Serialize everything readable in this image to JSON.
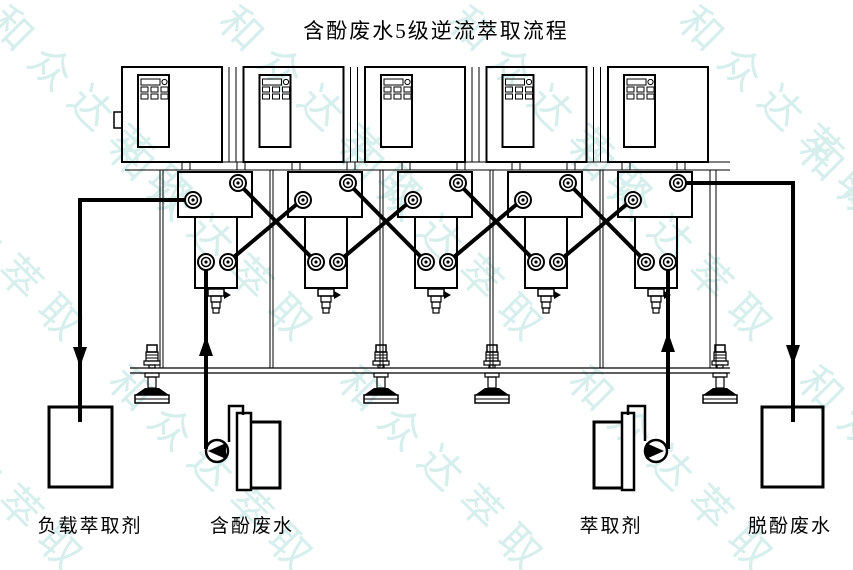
{
  "title": "含酚废水5级逆流萃取流程",
  "diagram": {
    "stage_count": 5
  },
  "tanks": {
    "loaded_extractant": "负载萃取剂",
    "phenol_wastewater": "含酚废水",
    "extractant": "萃取剂",
    "dephenolized_wastewater": "脱酚废水"
  },
  "watermark": {
    "text": "和众达萃取",
    "color": "#d6efec",
    "positions": [
      [
        20,
        -10
      ],
      [
        250,
        -10
      ],
      [
        480,
        -10
      ],
      [
        710,
        -10
      ],
      [
        -90,
        120
      ],
      [
        140,
        120
      ],
      [
        370,
        120
      ],
      [
        600,
        120
      ],
      [
        830,
        120
      ],
      [
        -90,
        350
      ],
      [
        140,
        350
      ],
      [
        370,
        350
      ],
      [
        600,
        350
      ],
      [
        830,
        350
      ]
    ]
  },
  "colors": {
    "line": "#000000",
    "background": "#ffffff"
  }
}
